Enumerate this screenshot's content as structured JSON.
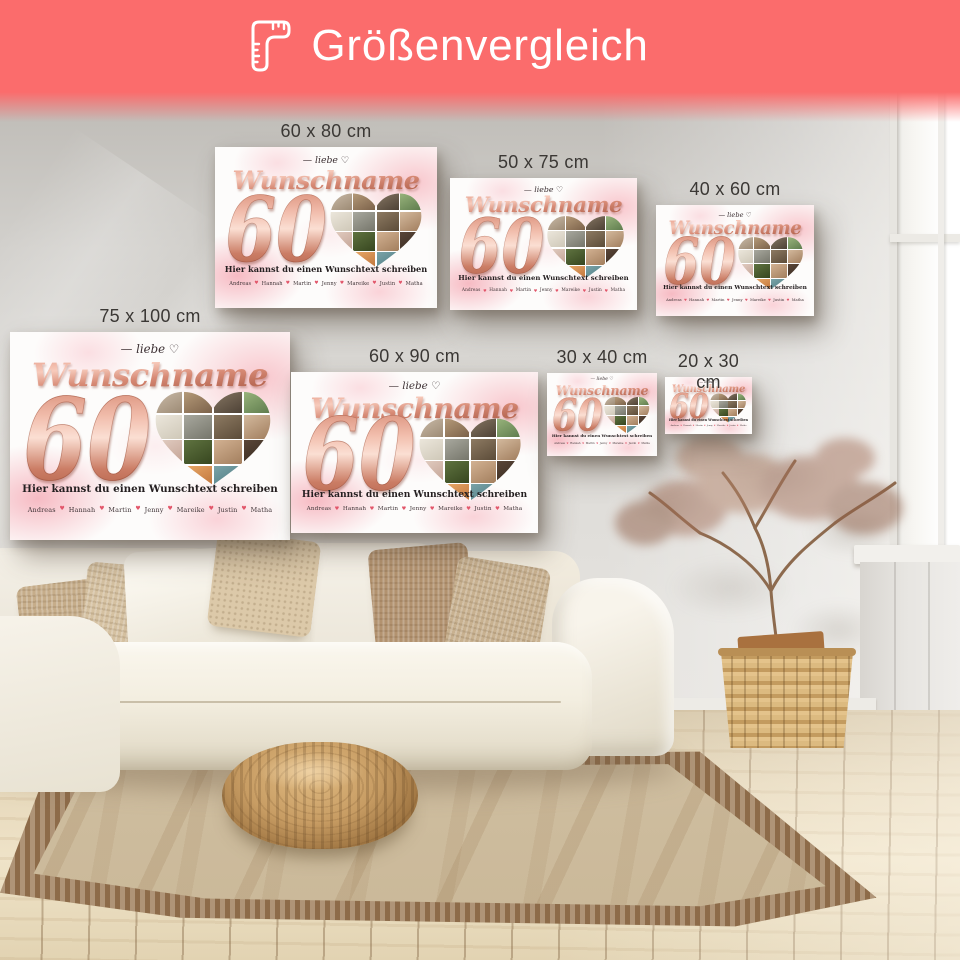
{
  "header": {
    "title": "Größenvergleich",
    "icon": "ruler-icon",
    "background_color": "#fb6c6c",
    "text_color": "#ffffff"
  },
  "poster_design": {
    "overline": "— liebe ♡",
    "name": "Wunschname",
    "number": "60",
    "subtext": "Hier kannst du einen Wunschtext schreiben",
    "names": [
      "Andreas",
      "Hannah",
      "Martin",
      "Jenny",
      "Mareike",
      "Justin",
      "Matha"
    ],
    "name_separator": "♥",
    "colors": {
      "rose_gold": "#cf8470",
      "rose_gold_light": "#f7cbbc",
      "rose_gold_dark": "#b05f49",
      "heart_red": "#e2566a",
      "text_dark": "#241f20",
      "watercolor_pink": "#f6a9b6"
    },
    "collage_colors": [
      [
        "#cfc0ae",
        "#9d8b75"
      ],
      [
        "#b99e7c",
        "#7c624a"
      ],
      [
        "#8a7a66",
        "#4e4236"
      ],
      [
        "#9db87f",
        "#5d7a4c"
      ],
      [
        "#ece7dc",
        "#cfc8b8"
      ],
      [
        "#a8a89e",
        "#76766b"
      ],
      [
        "#8d7a62",
        "#5c4c39"
      ],
      [
        "#d3b99d",
        "#a07c5c"
      ],
      [
        "#e3cfc4",
        "#c3a294"
      ],
      [
        "#5f7340",
        "#37461f"
      ],
      [
        "#d2b192",
        "#a37f5e"
      ],
      [
        "#5a4638",
        "#32251c"
      ],
      [
        "#f0ece3",
        "#d8d2c4"
      ],
      [
        "#e8a868",
        "#bc6f36"
      ],
      [
        "#7ba3a8",
        "#46757c"
      ],
      [
        "#d8c2a6",
        "#ab8c68"
      ]
    ]
  },
  "posters": [
    {
      "label": "60 x 80 cm",
      "x": 215,
      "y": 147,
      "w": 222,
      "h": 161
    },
    {
      "label": "50 x 75 cm",
      "x": 450,
      "y": 178,
      "w": 187,
      "h": 132
    },
    {
      "label": "40 x 60 cm",
      "x": 656,
      "y": 205,
      "w": 158,
      "h": 111
    },
    {
      "label": "75 x 100 cm",
      "x": 10,
      "y": 332,
      "w": 280,
      "h": 208
    },
    {
      "label": "60 x 90 cm",
      "x": 291,
      "y": 372,
      "w": 247,
      "h": 161
    },
    {
      "label": "30 x 40 cm",
      "x": 547,
      "y": 373,
      "w": 110,
      "h": 83
    },
    {
      "label": "20 x 30 cm",
      "x": 665,
      "y": 377,
      "w": 87,
      "h": 57
    }
  ]
}
